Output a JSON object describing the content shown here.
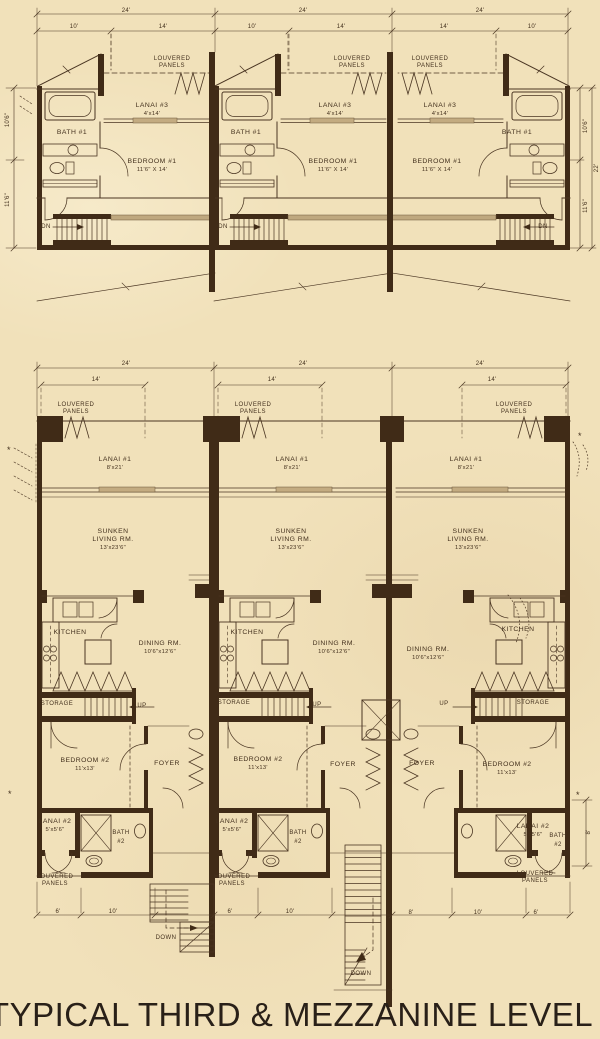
{
  "title": "TYPICAL THIRD & MEZZANINE LEVEL",
  "plans": {
    "mezzanine": {
      "louvered_panels": {
        "line1": "LOUVERED",
        "line2": "PANELS"
      },
      "lanai3": {
        "name": "LANAI #3",
        "size": "4'x14'"
      },
      "bath1": {
        "name": "BATH #1"
      },
      "bedroom1": {
        "name": "BEDROOM #1",
        "size": "11'6\" X 14'"
      },
      "stair_down_abbr": "DN"
    },
    "third": {
      "louvered_panels": {
        "line1": "LOUVERED",
        "line2": "PANELS"
      },
      "lanai1": {
        "name": "LANAI #1",
        "size": "8'x21'"
      },
      "sunken_living": {
        "line1": "SUNKEN",
        "line2": "LIVING RM.",
        "size": "13'x23'6\""
      },
      "kitchen": {
        "name": "KITCHEN"
      },
      "dining": {
        "name": "DINING RM.",
        "size": "10'6\"x12'6\""
      },
      "storage": {
        "name": "STORAGE"
      },
      "stair_up": "UP",
      "bedroom2": {
        "name": "BEDROOM #2",
        "size": "11'x13'"
      },
      "foyer": {
        "name": "FOYER"
      },
      "lanai2": {
        "name": "LANAI #2",
        "size": "5'x5'6\""
      },
      "bath2": {
        "line1": "BATH",
        "line2": "#2"
      },
      "stair_down": "DOWN"
    }
  },
  "dimensions": {
    "d24": "24'",
    "d14": "14'",
    "d10": "10'",
    "d8": "8'",
    "d6": "6'",
    "d10_6": "10'6\"",
    "d11_6": "11'6\"",
    "d22": "22'"
  },
  "symbols": {
    "asterisk": "*"
  },
  "colors": {
    "paper": "#f1e1ba",
    "ink": "#4a3522",
    "wall": "#402b17",
    "title": "#292018"
  }
}
